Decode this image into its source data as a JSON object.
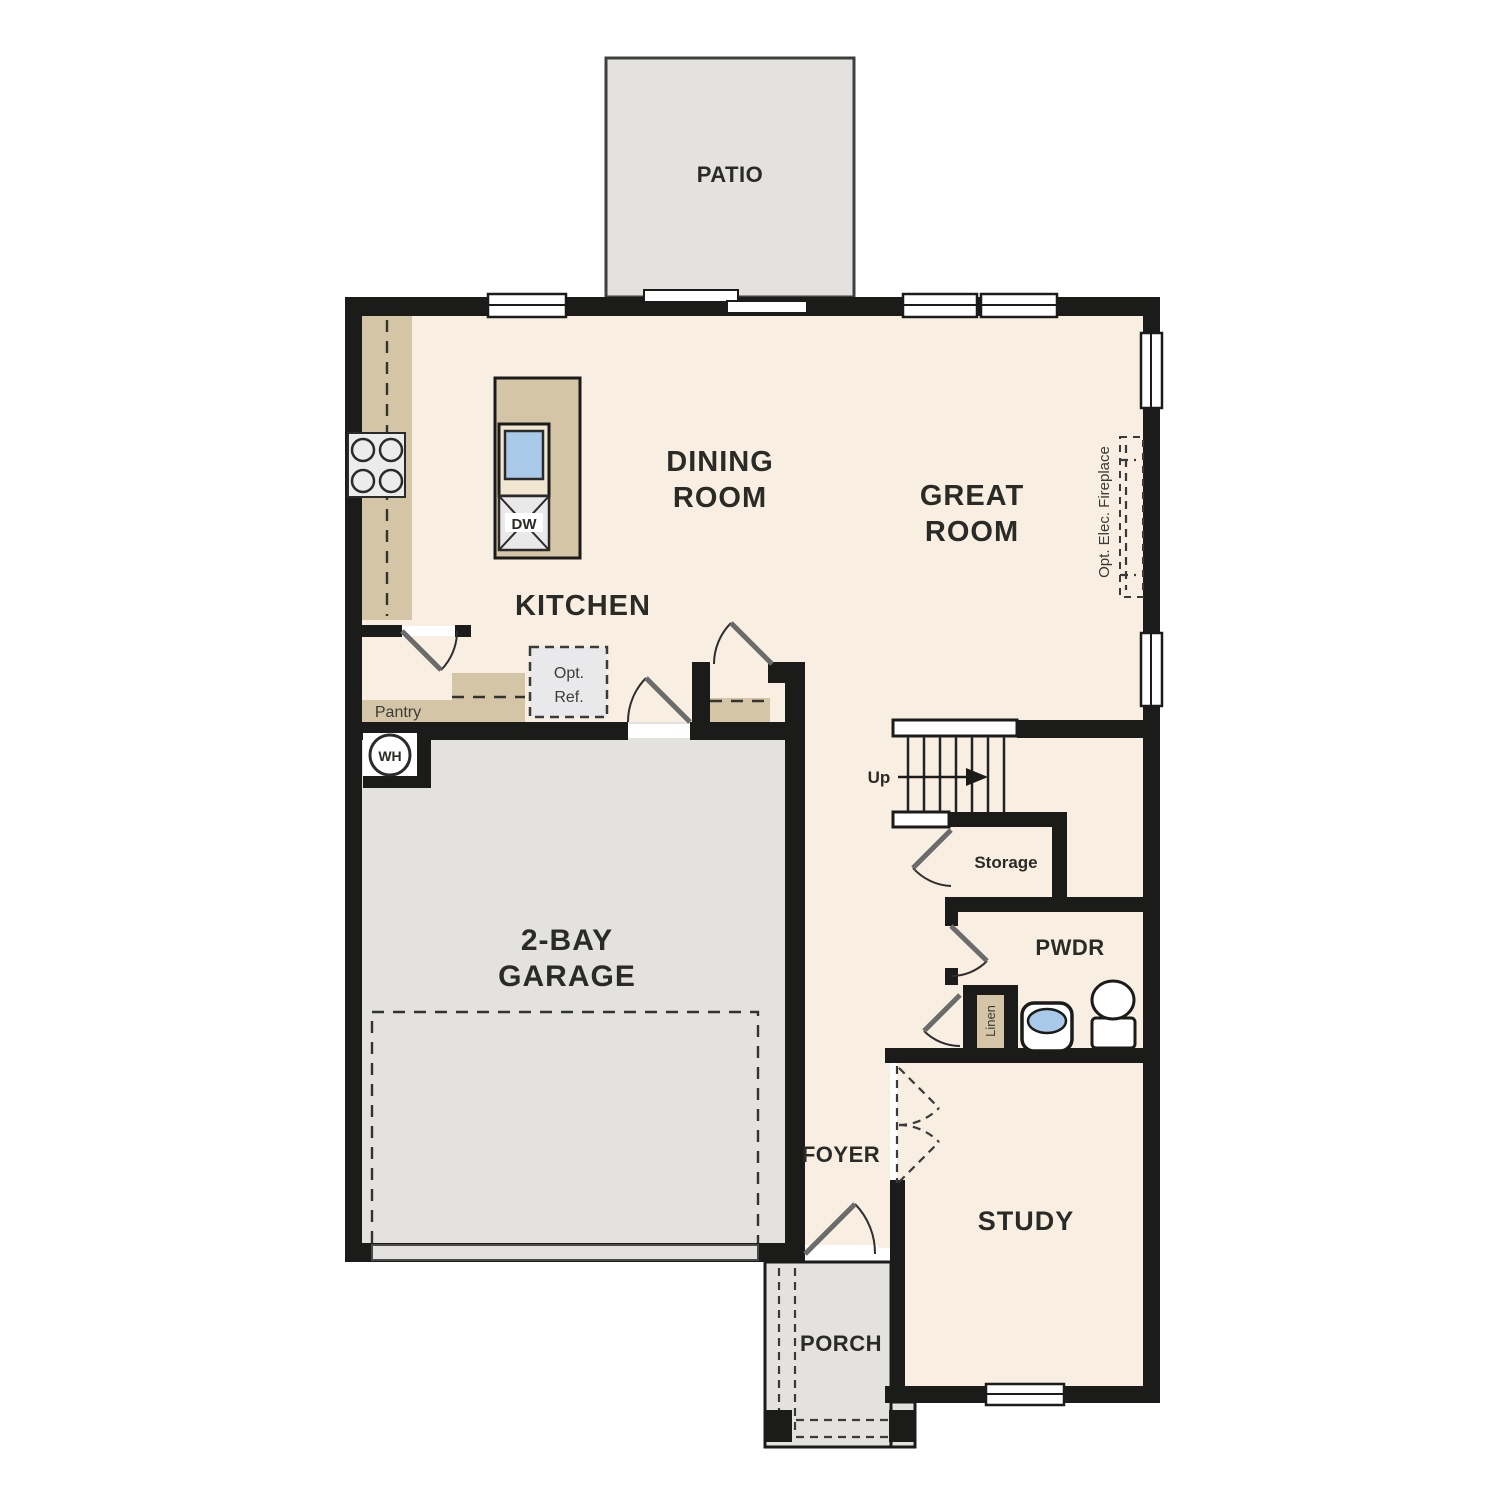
{
  "canvas": {
    "width": 1500,
    "height": 1500
  },
  "rooms": {
    "patio": "PATIO",
    "dining": [
      "DINING",
      "ROOM"
    ],
    "great": [
      "GREAT",
      "ROOM"
    ],
    "kitchen": "KITCHEN",
    "garage": [
      "2-BAY",
      "GARAGE"
    ],
    "foyer": "FOYER",
    "study": "STUDY",
    "porch": "PORCH",
    "pwdr": "PWDR",
    "storage": "Storage",
    "pantry": "Pantry"
  },
  "fixtures": {
    "dishwasher": "DW",
    "water_heater": "WH",
    "stairs_direction": "Up",
    "linen": "Linen",
    "opt_ref": [
      "Opt.",
      "Ref."
    ],
    "fireplace": "Opt. Elec. Fireplace"
  },
  "colors": {
    "wall": "#1b1b19",
    "floor": "#f8efe2",
    "counter": "#d4c5a6",
    "exterior_gray": "#e3e2df",
    "optional_gray": "#e9e9eb",
    "sink_blue": "#a9c9e9",
    "text": "#2a2a26"
  }
}
